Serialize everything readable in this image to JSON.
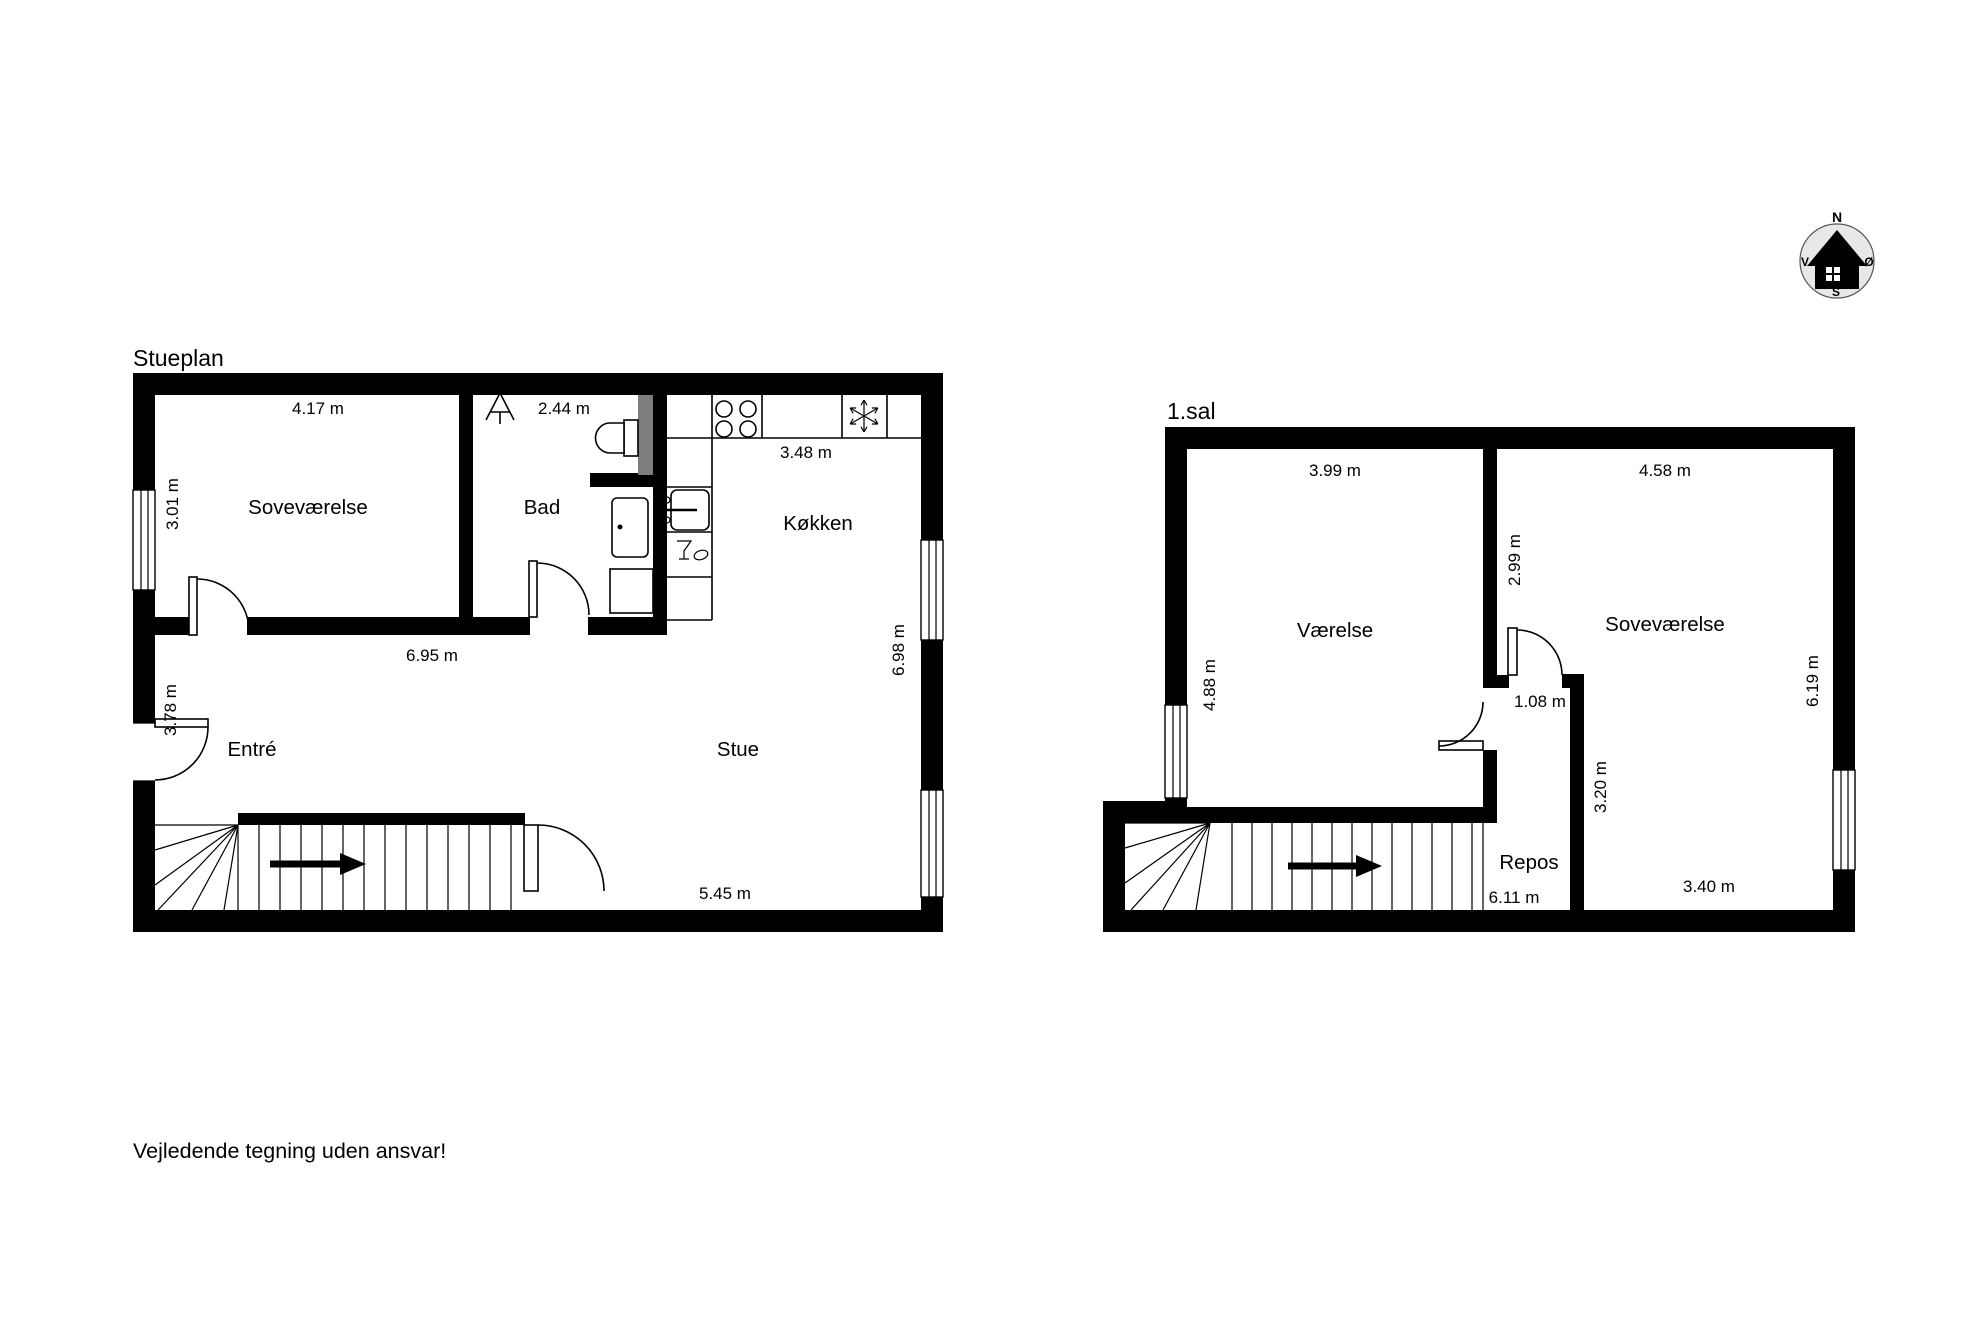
{
  "page": {
    "background": "#ffffff",
    "drawing_color": "#000000",
    "duct_gray": "#7d7d7d",
    "compass_fill": "#e8e8e8"
  },
  "disclaimer": "Vejledende tegning uden ansvar!",
  "compass": {
    "north": "N",
    "south": "S",
    "west": "V",
    "east": "Ø"
  },
  "ground_floor": {
    "title": "Stueplan",
    "rooms": {
      "bedroom": "Soveværelse",
      "bathroom": "Bad",
      "kitchen": "Køkken",
      "hall": "Entré",
      "living_room": "Stue"
    },
    "dims": {
      "bedroom_width": "4.17 m",
      "bedroom_height": "3.01 m",
      "bathroom_width": "2.44 m",
      "kitchen_width": "3.48 m",
      "middle_width": "6.95 m",
      "hall_height": "3.78 m",
      "living_height": "6.98 m",
      "living_width": "5.45 m"
    }
  },
  "first_floor": {
    "title": "1.sal",
    "rooms": {
      "room": "Værelse",
      "bedroom": "Soveværelse",
      "landing": "Repos"
    },
    "dims": {
      "room_width": "3.99 m",
      "room_height": "4.88 m",
      "bedroom_width": "4.58 m",
      "partition_height": "2.99 m",
      "door_width": "1.08 m",
      "landing_wall_height": "3.20 m",
      "bedroom_bottom_width": "3.40 m",
      "stair_length": "6.11 m",
      "bedroom_height": "6.19 m"
    }
  }
}
